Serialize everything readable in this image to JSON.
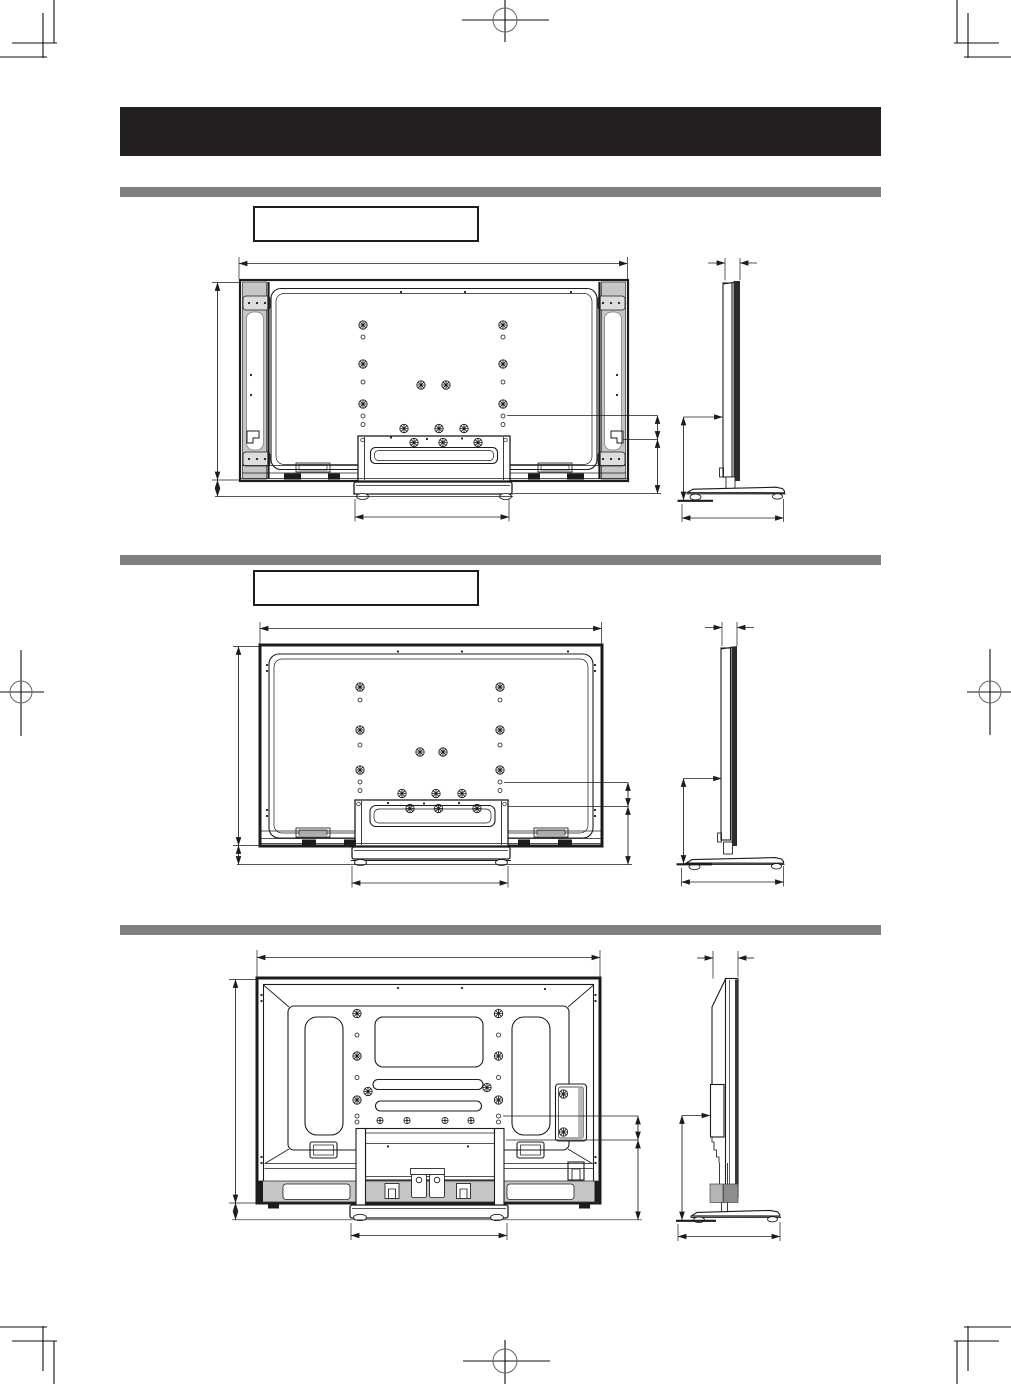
{
  "header": {
    "label": ""
  },
  "sections": [
    {
      "label": ""
    },
    {
      "label": ""
    },
    {}
  ],
  "colors": {
    "page_background": "#ffffff",
    "header_bar": "#231f20",
    "divider_bar": "#7f7f7f",
    "line": "#1c1c1c",
    "speaker_gray": "#c6c6c6",
    "screen_dark": "#2f2b2c"
  }
}
